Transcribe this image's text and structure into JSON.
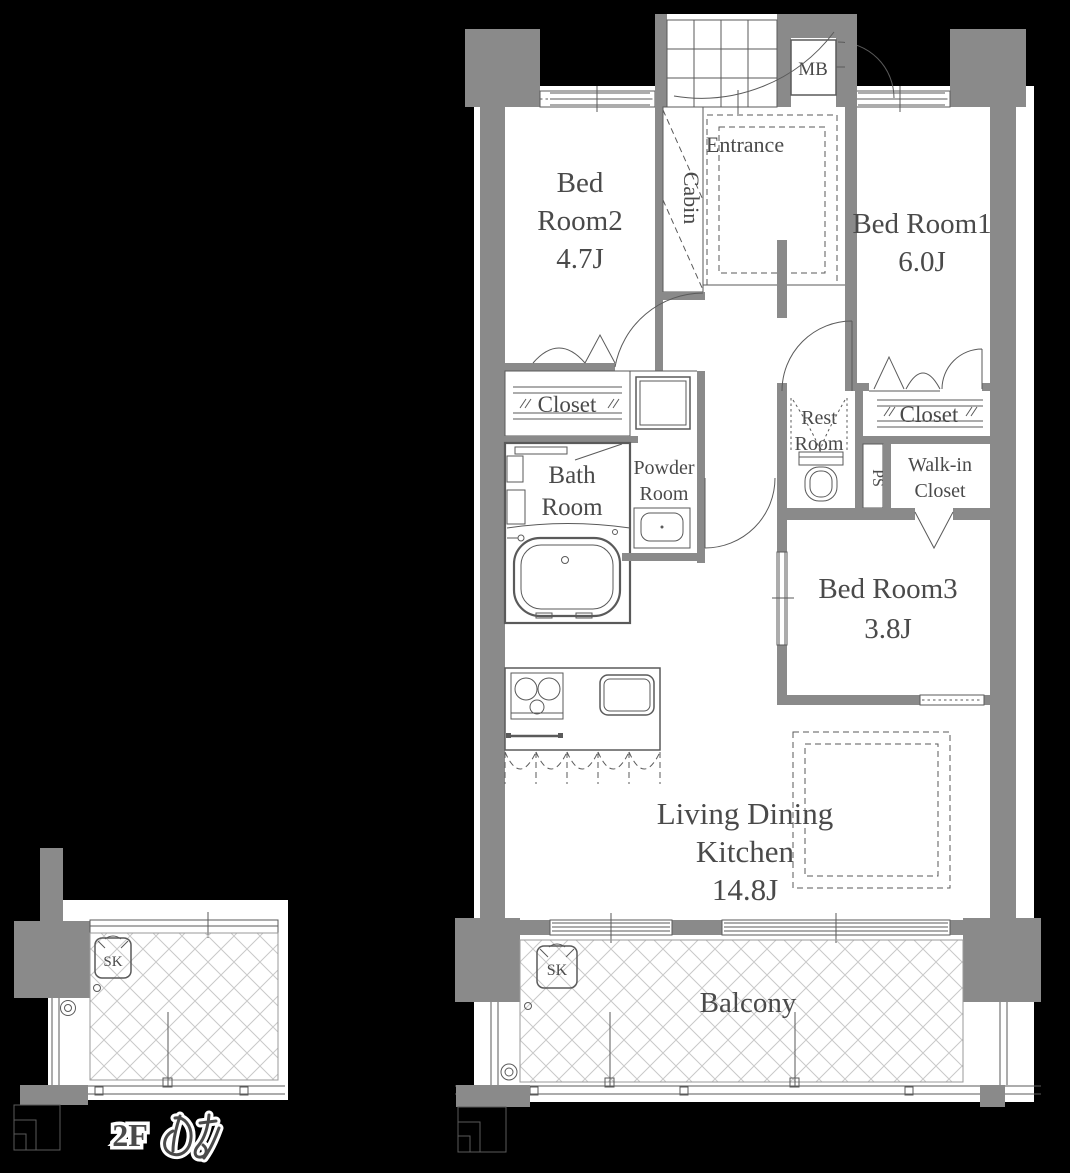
{
  "colors": {
    "background": "#000000",
    "wall": "#8a8a8a",
    "line": "#5a5a5a",
    "text": "#4a4a4a",
    "floor": "#ffffff",
    "hatch": "#c9c9c9"
  },
  "unit": {
    "entrance": "Entrance",
    "cabin": "Cabin",
    "mb": "MB",
    "bed2": {
      "l1": "Bed",
      "l2": "Room2",
      "size": "4.7J"
    },
    "bed1": {
      "name": "Bed Room1",
      "size": "6.0J"
    },
    "bed3": {
      "name": "Bed Room3",
      "size": "3.8J"
    },
    "closet_bed2": "Closet",
    "closet_bed1": "Closet",
    "bath": {
      "l1": "Bath",
      "l2": "Room"
    },
    "powder": {
      "l1": "Powder",
      "l2": "Room"
    },
    "rest": {
      "l1": "Rest",
      "l2": "Room"
    },
    "ps": "PS",
    "wic": {
      "l1": "Walk-in",
      "l2": "Closet"
    },
    "ldk": {
      "l1": "Living Dining",
      "l2": "Kitchen",
      "size": "14.8J"
    },
    "balcony": "Balcony",
    "sk": "SK"
  },
  "annex": {
    "sk": "SK",
    "note": "2Fのみ",
    "note_prefix": "2F"
  }
}
